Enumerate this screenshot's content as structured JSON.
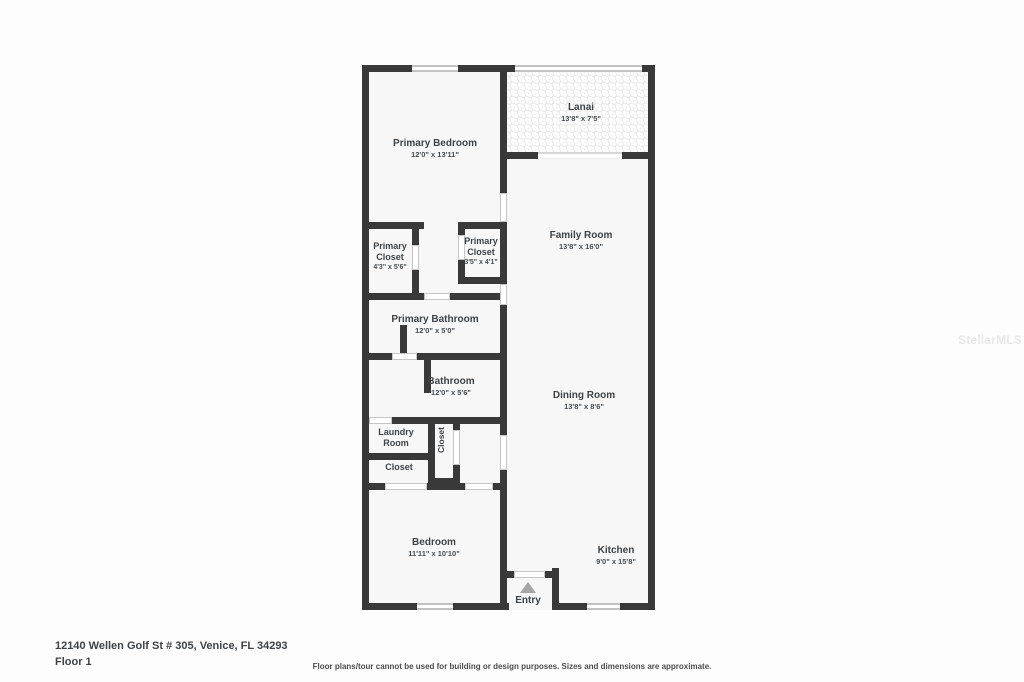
{
  "page": {
    "address": "12140 Wellen Golf St # 305, Venice, FL 34293",
    "floor_label": "Floor 1",
    "disclaimer": "Floor plans/tour cannot be used for building or design purposes. Sizes and dimensions are approximate.",
    "watermark": "StellarMLS"
  },
  "colors": {
    "wall": "#393939",
    "floor": "#f7f7f7",
    "text": "#3e4347"
  },
  "rooms": {
    "primary_bedroom": {
      "name": "Primary Bedroom",
      "dims": "12'0\" x 13'11\""
    },
    "lanai": {
      "name": "Lanai",
      "dims": "13'8\" x 7'5\""
    },
    "family_room": {
      "name": "Family Room",
      "dims": "13'8\" x 16'0\""
    },
    "primary_closet_left": {
      "name": "Primary Closet",
      "dims": "4'3\" x 5'6\""
    },
    "primary_closet_right": {
      "name": "Primary Closet",
      "dims": "3'5\" x 4'1\""
    },
    "primary_bathroom": {
      "name": "Primary Bathroom",
      "dims": "12'0\" x 5'0\""
    },
    "bathroom": {
      "name": "Bathroom",
      "dims": "12'0\" x 5'6\""
    },
    "dining_room": {
      "name": "Dining Room",
      "dims": "13'8\" x 8'6\""
    },
    "laundry_room": {
      "name": "Laundry Room"
    },
    "closet_hall": {
      "name": "Closet"
    },
    "closet_small": {
      "name": "Closet"
    },
    "bedroom": {
      "name": "Bedroom",
      "dims": "11'11\" x 10'10\""
    },
    "kitchen": {
      "name": "Kitchen",
      "dims": "9'0\" x 15'8\""
    },
    "entry": {
      "name": "Entry"
    }
  }
}
